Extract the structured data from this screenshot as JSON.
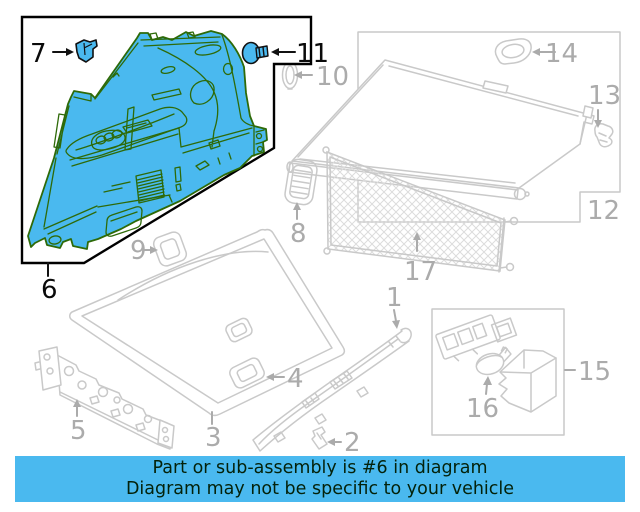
{
  "banner": {
    "line1": "Part or sub-assembly is #6 in diagram",
    "line2": "Diagram may not be specific to your vehicle",
    "bg_color": "#4ab9ef",
    "text_color": "#04220a"
  },
  "colors": {
    "highlight_fill": "#4ab9ef",
    "highlight_outline": "#2e6a08",
    "lineart_gray": "#c9c9c9",
    "label_gray": "#ababab",
    "label_black": "#0a0a0a",
    "callout_box": "#000000"
  },
  "highlighted_part": "6",
  "parts": [
    {
      "num": "1",
      "name": "rear-sill-trim-plate"
    },
    {
      "num": "2",
      "name": "sill-clip"
    },
    {
      "num": "3",
      "name": "load-floor-panel"
    },
    {
      "num": "4",
      "name": "floor-latch-cup"
    },
    {
      "num": "5",
      "name": "floor-extension-bracket"
    },
    {
      "num": "6",
      "name": "quarter-trim-panel"
    },
    {
      "num": "7",
      "name": "trim-clip"
    },
    {
      "num": "8",
      "name": "vent-grille"
    },
    {
      "num": "9",
      "name": "trim-bezel"
    },
    {
      "num": "10",
      "name": "grommet"
    },
    {
      "num": "11",
      "name": "push-clip"
    },
    {
      "num": "12",
      "name": "cargo-cover-assembly"
    },
    {
      "num": "13",
      "name": "cover-retainer-clip"
    },
    {
      "num": "14",
      "name": "cover-end-bezel"
    },
    {
      "num": "15",
      "name": "cargo-lamp-kit"
    },
    {
      "num": "16",
      "name": "lamp-bulb"
    },
    {
      "num": "17",
      "name": "cargo-net"
    }
  ]
}
